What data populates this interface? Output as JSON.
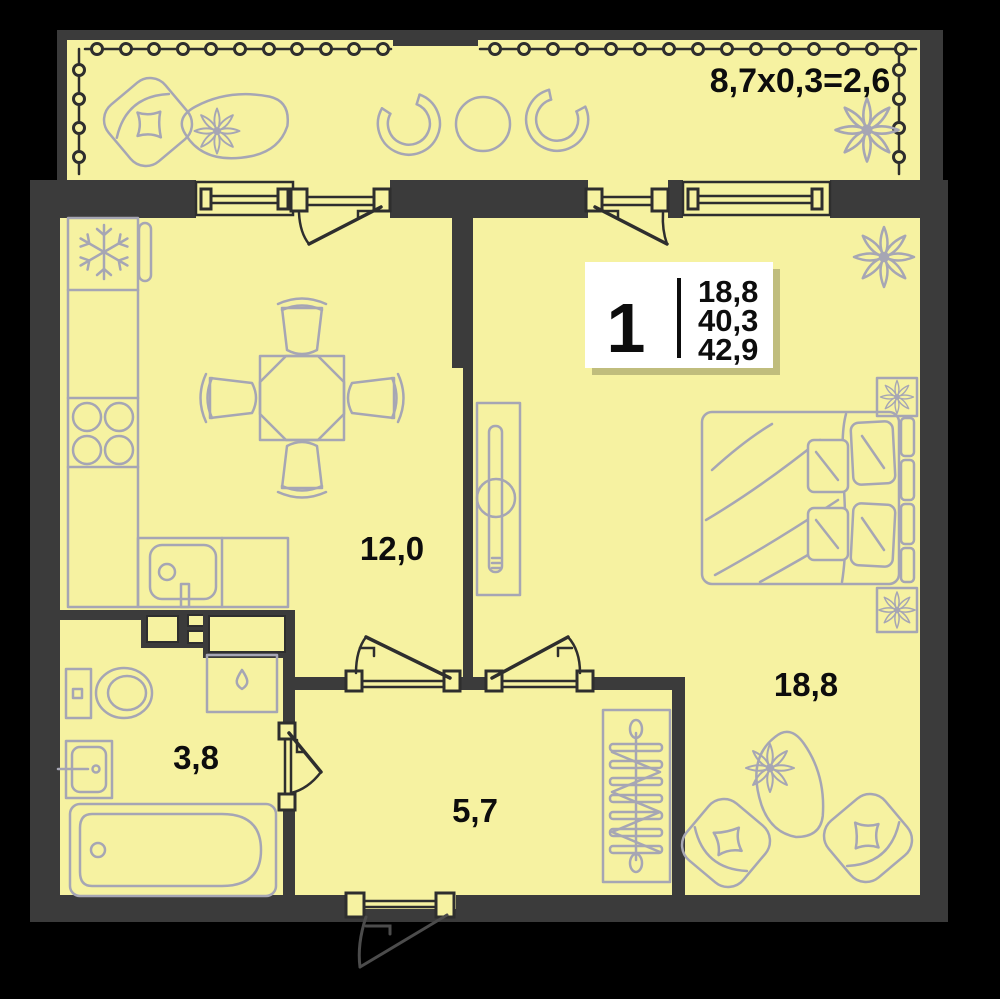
{
  "floorplan": {
    "type_label": "floor plan of 1-room apartment",
    "balcony": {
      "dimension_label": "8,7x0,3=2,6"
    },
    "rooms": [
      {
        "id": "kitchen-living",
        "area_label": "12,0"
      },
      {
        "id": "bedroom",
        "area_label": "18,8"
      },
      {
        "id": "bathroom",
        "area_label": "3,8"
      },
      {
        "id": "hallway",
        "area_label": "5,7"
      }
    ],
    "info_badge": {
      "room_count": "1",
      "areas": [
        "18,8",
        "40,3",
        "42,9"
      ]
    },
    "icons": [
      {
        "name": "snowflake-icon",
        "meaning": "fridge/freezer spot"
      },
      {
        "name": "droplet-icon",
        "meaning": "washing machine spot"
      },
      {
        "name": "flower-icon",
        "meaning": "plant / decor"
      }
    ],
    "colors": {
      "background": "#000000",
      "wall": "#3b3b3b",
      "floor": "#f6f2a1",
      "furniture": "#a6a6b4",
      "frame_lines": "#2e2e2e",
      "badge_background": "#ffffff",
      "text": "#0d0d0d"
    }
  }
}
